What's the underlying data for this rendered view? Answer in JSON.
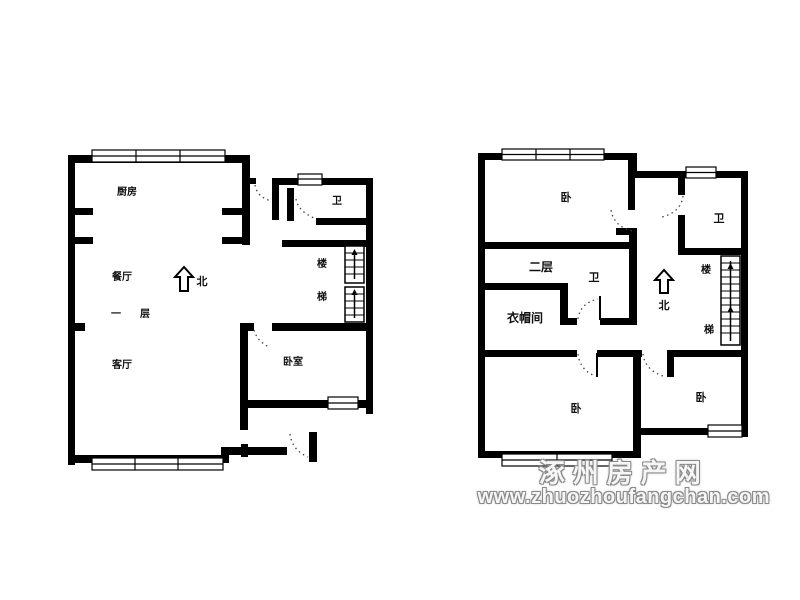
{
  "image": {
    "type": "residential floor plan, two levels side by side",
    "background": "#ffffff",
    "wall_color": "#000000"
  },
  "first_floor": {
    "kitchen": "厨房",
    "bath": "卫",
    "dining": "餐厅",
    "floor_char_1": "一",
    "floor_char_2": "层",
    "north": "北",
    "living": "客厅",
    "bedroom": "卧室",
    "stairs_char_1": "楼",
    "stairs_char_2": "梯"
  },
  "second_floor": {
    "bedroom_top": "卧",
    "bath_right": "卫",
    "floor_label": "二层",
    "bath_center": "卫",
    "north": "北",
    "stairs_char_1": "楼",
    "stairs_char_2": "梯",
    "cloakroom": "衣帽间",
    "bedroom_bottom_left": "卧",
    "bedroom_bottom_right": "卧"
  },
  "watermark": {
    "site_name": "涿州房产网",
    "site_url": "www.zhuozhoufangchan.com",
    "fill_color": "#ffffff",
    "outline_color": "#8a8a8a"
  }
}
